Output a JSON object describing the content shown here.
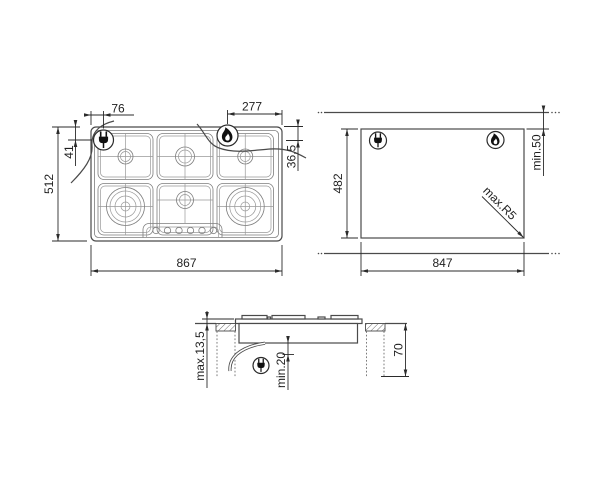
{
  "colors": {
    "background": "#ffffff",
    "drawing_line": "#4a4a4a",
    "fine_line": "#7d7d7d",
    "dimension_text": "#1f1f1f"
  },
  "icons": {
    "plug": "power-plug-icon",
    "flame": "gas-flame-icon"
  },
  "plan_view": {
    "width": "867",
    "depth": "512",
    "plug_from_left": "76",
    "plug_from_top": "41",
    "flame_from_right": "277",
    "flame_from_top": "36,5"
  },
  "cutout_view": {
    "width": "847",
    "depth": "482",
    "rear_clearance": "min.50",
    "corner_radius": "max.R5"
  },
  "side_view": {
    "height_above_worktop": "max.13,5",
    "clearance_below": "min.20",
    "install_depth": "70"
  }
}
